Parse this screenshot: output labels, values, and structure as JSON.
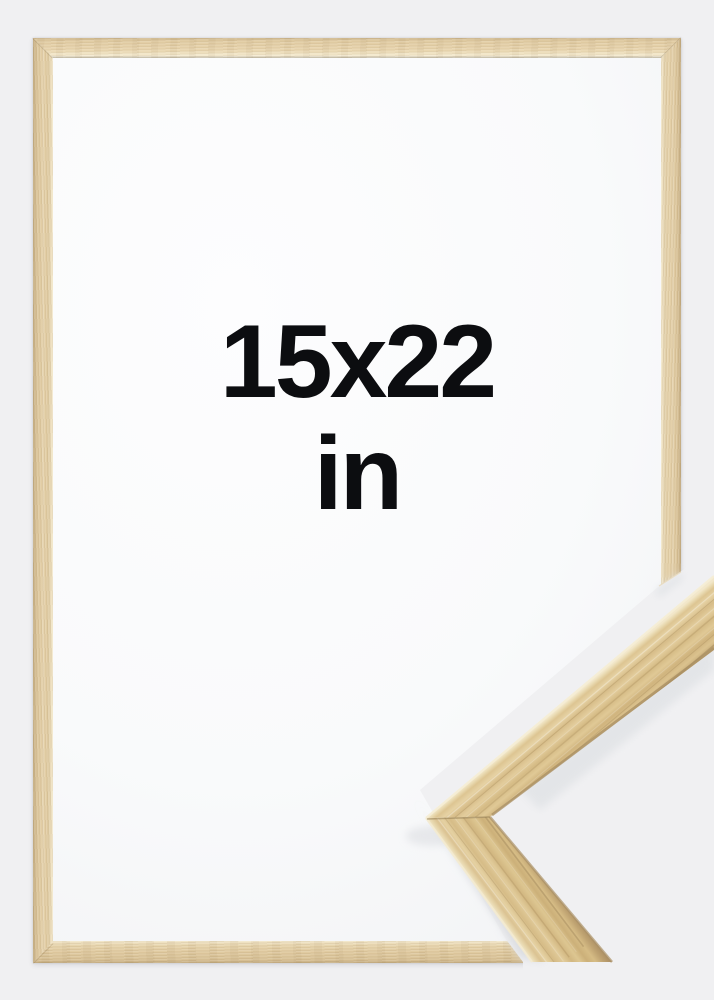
{
  "product_image": {
    "size_label": {
      "line1": "15x22",
      "line2": "in"
    },
    "frame": {
      "style": "thin-wood-frame",
      "orientation": "portrait"
    },
    "corner_sample": {
      "description": "close-up corner of wood moulding overlapping bottom-right"
    }
  },
  "colors": {
    "background": "#f0f0f2",
    "interior": "#fcfcfd",
    "wood_base": "#e3cfa7",
    "wood_streak_dark": "#c9ae7e",
    "wood_highlight": "#f3e8cd",
    "text": "#0c0d10"
  }
}
